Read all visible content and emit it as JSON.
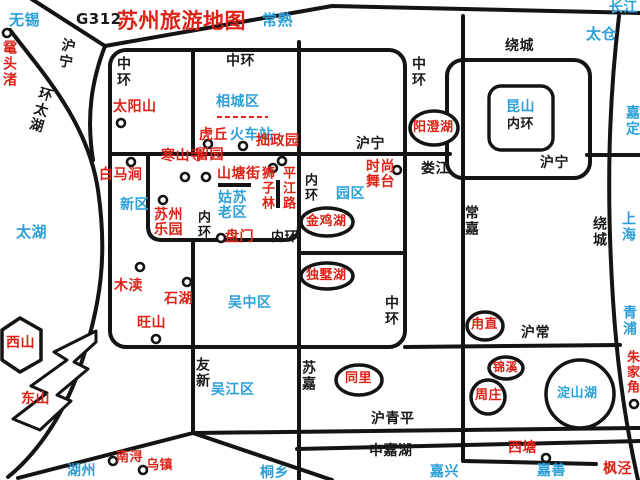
{
  "title": "苏州旅游地图",
  "colors": {
    "red": "#dd2318",
    "blue": "#2ba0d8",
    "black": "#1a1a1a",
    "road": "#141414",
    "bg": "#ffffff"
  },
  "labels": [
    {
      "n": "city-wuxi",
      "t": "无锡",
      "x": 9,
      "y": 12,
      "c": "blue",
      "s": 15
    },
    {
      "n": "road-g312-label",
      "t": "G312",
      "x": 76,
      "y": 11,
      "c": "black",
      "s": 15
    },
    {
      "n": "map-title",
      "t": "苏州旅游地图",
      "x": 117,
      "y": 10,
      "c": "red",
      "s": 21
    },
    {
      "n": "city-changshu",
      "t": "常熟",
      "x": 262,
      "y": 12,
      "c": "blue",
      "s": 15
    },
    {
      "n": "river-changjiang",
      "t": "长江",
      "x": 609,
      "y": 1,
      "c": "blue",
      "s": 14
    },
    {
      "n": "poi-yuantouzhu",
      "t": "鼋头渚",
      "x": 2,
      "y": 40,
      "c": "red",
      "s": 14,
      "d": "v"
    },
    {
      "n": "road-huning-northwest",
      "t": "沪宁",
      "x": 62,
      "y": 37,
      "c": "black",
      "s": 14,
      "d": "v",
      "r": 10
    },
    {
      "n": "road-huantaihu",
      "t": "环太湖",
      "x": 40,
      "y": 85,
      "c": "black",
      "s": 14,
      "d": "v",
      "r": 16
    },
    {
      "n": "lake-taihu",
      "t": "太湖",
      "x": 16,
      "y": 224,
      "c": "blue",
      "s": 15
    },
    {
      "n": "road-zhonghuan-west",
      "t": "中环",
      "x": 116,
      "y": 56,
      "c": "black",
      "s": 14,
      "d": "v"
    },
    {
      "n": "road-zhonghuan-north",
      "t": "中环",
      "x": 226,
      "y": 54,
      "c": "black",
      "s": 14
    },
    {
      "n": "road-zhonghuan-northeast",
      "t": "中环",
      "x": 411,
      "y": 56,
      "c": "black",
      "s": 14,
      "d": "v"
    },
    {
      "n": "road-raocheng-north",
      "t": "绕城",
      "x": 505,
      "y": 39,
      "c": "black",
      "s": 14
    },
    {
      "n": "city-taicang",
      "t": "太仓",
      "x": 586,
      "y": 26,
      "c": "blue",
      "s": 15
    },
    {
      "n": "city-jiading",
      "t": "嘉定",
      "x": 625,
      "y": 105,
      "c": "blue",
      "s": 14,
      "d": "v"
    },
    {
      "n": "poi-taiyangshan",
      "t": "太阳山",
      "x": 113,
      "y": 100,
      "c": "red",
      "s": 14
    },
    {
      "n": "district-xiangcheng",
      "t": "相城区",
      "x": 216,
      "y": 95,
      "c": "blue",
      "s": 14
    },
    {
      "n": "poi-huqiu",
      "t": "虎丘",
      "x": 199,
      "y": 128,
      "c": "red",
      "s": 14
    },
    {
      "n": "poi-huochezhan",
      "t": "火车站",
      "x": 230,
      "y": 128,
      "c": "blue",
      "s": 14
    },
    {
      "n": "poi-zhuozhengyuan",
      "t": "拙政园",
      "x": 256,
      "y": 134,
      "c": "red",
      "s": 14
    },
    {
      "n": "poi-hanshansi",
      "t": "寒山寺",
      "x": 161,
      "y": 149,
      "c": "red",
      "s": 14
    },
    {
      "n": "poi-liuyuan",
      "t": "留园",
      "x": 195,
      "y": 148,
      "c": "red",
      "s": 14
    },
    {
      "n": "poi-shantangjie",
      "t": "山塘街",
      "x": 217,
      "y": 167,
      "c": "red",
      "s": 14
    },
    {
      "n": "poi-shizilin",
      "t": "狮子林",
      "x": 260,
      "y": 166,
      "c": "red",
      "s": 13,
      "d": "v"
    },
    {
      "n": "road-pingjianglu",
      "t": "平江路",
      "x": 281,
      "y": 166,
      "c": "red",
      "s": 13,
      "d": "v"
    },
    {
      "n": "poi-baimajian",
      "t": "白马涧",
      "x": 99,
      "y": 168,
      "c": "red",
      "s": 14
    },
    {
      "n": "district-xinqu",
      "t": "新区",
      "x": 120,
      "y": 198,
      "c": "blue",
      "s": 14
    },
    {
      "n": "poi-suzhou-leyuan",
      "t": "苏州\n乐园",
      "x": 154,
      "y": 208,
      "c": "red",
      "s": 14
    },
    {
      "n": "district-gusu-laoqu",
      "t": "姑苏\n老区",
      "x": 218,
      "y": 191,
      "c": "blue",
      "s": 14
    },
    {
      "n": "road-neihuan-west",
      "t": "内环",
      "x": 196,
      "y": 210,
      "c": "black",
      "s": 13,
      "d": "v"
    },
    {
      "n": "road-neihuan-south",
      "t": "内环",
      "x": 271,
      "y": 231,
      "c": "black",
      "s": 13
    },
    {
      "n": "road-neihuan-east",
      "t": "内环",
      "x": 303,
      "y": 173,
      "c": "black",
      "s": 13,
      "d": "v"
    },
    {
      "n": "poi-panmen",
      "t": "盘门",
      "x": 225,
      "y": 230,
      "c": "red",
      "s": 14
    },
    {
      "n": "road-huning-west",
      "t": "沪宁",
      "x": 356,
      "y": 137,
      "c": "black",
      "s": 14
    },
    {
      "n": "river-loujiang",
      "t": "娄江",
      "x": 421,
      "y": 162,
      "c": "black",
      "s": 14
    },
    {
      "n": "poi-shishang-wutai",
      "t": "时尚\n舞台",
      "x": 366,
      "y": 160,
      "c": "red",
      "s": 14
    },
    {
      "n": "district-yuanqu",
      "t": "园区",
      "x": 336,
      "y": 187,
      "c": "blue",
      "s": 14
    },
    {
      "n": "lake-jinjihu",
      "t": "金鸡湖",
      "x": 306,
      "y": 215,
      "c": "red",
      "s": 13
    },
    {
      "n": "lake-yangchenghu",
      "t": "阳澄湖",
      "x": 413,
      "y": 121,
      "c": "red",
      "s": 13
    },
    {
      "n": "city-kunshan",
      "t": "昆山",
      "x": 506,
      "y": 100,
      "c": "blue",
      "s": 14
    },
    {
      "n": "road-neihuan-kunshan",
      "t": "内环",
      "x": 507,
      "y": 118,
      "c": "black",
      "s": 13
    },
    {
      "n": "road-huning-east",
      "t": "沪宁",
      "x": 540,
      "y": 156,
      "c": "black",
      "s": 14
    },
    {
      "n": "road-changjia",
      "t": "常嘉",
      "x": 464,
      "y": 205,
      "c": "black",
      "s": 14,
      "d": "v"
    },
    {
      "n": "road-raocheng-east",
      "t": "绕城",
      "x": 592,
      "y": 216,
      "c": "black",
      "s": 14,
      "d": "v"
    },
    {
      "n": "city-shanghai",
      "t": "上海",
      "x": 621,
      "y": 211,
      "c": "blue",
      "s": 14,
      "d": "v"
    },
    {
      "n": "city-qingpu",
      "t": "青浦",
      "x": 622,
      "y": 305,
      "c": "blue",
      "s": 14,
      "d": "v"
    },
    {
      "n": "lake-dushuhu",
      "t": "独墅湖",
      "x": 306,
      "y": 269,
      "c": "red",
      "s": 13
    },
    {
      "n": "road-zhonghuan-southeast",
      "t": "中环",
      "x": 384,
      "y": 295,
      "c": "black",
      "s": 14,
      "d": "v"
    },
    {
      "n": "district-wuzhong",
      "t": "吴中区",
      "x": 228,
      "y": 296,
      "c": "blue",
      "s": 14
    },
    {
      "n": "poi-mudu",
      "t": "木渎",
      "x": 114,
      "y": 279,
      "c": "red",
      "s": 14
    },
    {
      "n": "poi-shihu",
      "t": "石湖",
      "x": 164,
      "y": 292,
      "c": "red",
      "s": 14
    },
    {
      "n": "poi-wangshan",
      "t": "旺山",
      "x": 137,
      "y": 316,
      "c": "red",
      "s": 14
    },
    {
      "n": "poi-xishan",
      "t": "西山",
      "x": 6,
      "y": 336,
      "c": "red",
      "s": 14
    },
    {
      "n": "poi-dongshan",
      "t": "东山",
      "x": 21,
      "y": 392,
      "c": "red",
      "s": 14
    },
    {
      "n": "town-luzhi",
      "t": "甪直",
      "x": 471,
      "y": 318,
      "c": "red",
      "s": 13
    },
    {
      "n": "road-huchang",
      "t": "沪常",
      "x": 521,
      "y": 326,
      "c": "black",
      "s": 14
    },
    {
      "n": "road-youxin",
      "t": "友新",
      "x": 195,
      "y": 357,
      "c": "black",
      "s": 14,
      "d": "v"
    },
    {
      "n": "district-wujiang",
      "t": "吴江区",
      "x": 211,
      "y": 383,
      "c": "blue",
      "s": 14
    },
    {
      "n": "road-sujia",
      "t": "苏嘉",
      "x": 301,
      "y": 360,
      "c": "black",
      "s": 14,
      "d": "v"
    },
    {
      "n": "town-tongli",
      "t": "同里",
      "x": 345,
      "y": 372,
      "c": "red",
      "s": 13
    },
    {
      "n": "town-jinxi",
      "t": "锦溪",
      "x": 493,
      "y": 361,
      "c": "red",
      "s": 12
    },
    {
      "n": "town-zhouzhuang",
      "t": "周庄",
      "x": 475,
      "y": 389,
      "c": "red",
      "s": 13
    },
    {
      "n": "lake-dianshanhu",
      "t": "淀山湖",
      "x": 557,
      "y": 387,
      "c": "blue",
      "s": 13
    },
    {
      "n": "town-zhujiajiao",
      "t": "朱家角",
      "x": 625,
      "y": 350,
      "c": "red",
      "s": 13,
      "d": "v"
    },
    {
      "n": "road-huqingping",
      "t": "沪青平",
      "x": 371,
      "y": 412,
      "c": "black",
      "s": 14
    },
    {
      "n": "road-shenjiahu",
      "t": "申嘉湖",
      "x": 369,
      "y": 444,
      "c": "black",
      "s": 14
    },
    {
      "n": "town-xitang",
      "t": "西塘",
      "x": 508,
      "y": 441,
      "c": "red",
      "s": 14
    },
    {
      "n": "city-huzhou",
      "t": "湖州",
      "x": 67,
      "y": 464,
      "c": "blue",
      "s": 14
    },
    {
      "n": "town-nanxun",
      "t": "南浔",
      "x": 116,
      "y": 451,
      "c": "red",
      "s": 13
    },
    {
      "n": "town-wuzhen",
      "t": "乌镇",
      "x": 146,
      "y": 459,
      "c": "red",
      "s": 13
    },
    {
      "n": "city-tongxiang",
      "t": "桐乡",
      "x": 260,
      "y": 466,
      "c": "blue",
      "s": 14
    },
    {
      "n": "city-jiaxing",
      "t": "嘉兴",
      "x": 430,
      "y": 465,
      "c": "blue",
      "s": 14
    },
    {
      "n": "city-jiashan",
      "t": "嘉善",
      "x": 537,
      "y": 464,
      "c": "blue",
      "s": 14
    },
    {
      "n": "town-fengjing",
      "t": "枫泾",
      "x": 603,
      "y": 462,
      "c": "red",
      "s": 14
    }
  ],
  "dots": [
    [
      7,
      33
    ],
    [
      121,
      123
    ],
    [
      208,
      144
    ],
    [
      243,
      146
    ],
    [
      185,
      177
    ],
    [
      206,
      177
    ],
    [
      273,
      168
    ],
    [
      282,
      161
    ],
    [
      131,
      162
    ],
    [
      163,
      200
    ],
    [
      221,
      238
    ],
    [
      397,
      170
    ],
    [
      140,
      267
    ],
    [
      187,
      282
    ],
    [
      156,
      339
    ],
    [
      113,
      461
    ],
    [
      143,
      470
    ],
    [
      546,
      458
    ],
    [
      634,
      404
    ]
  ]
}
